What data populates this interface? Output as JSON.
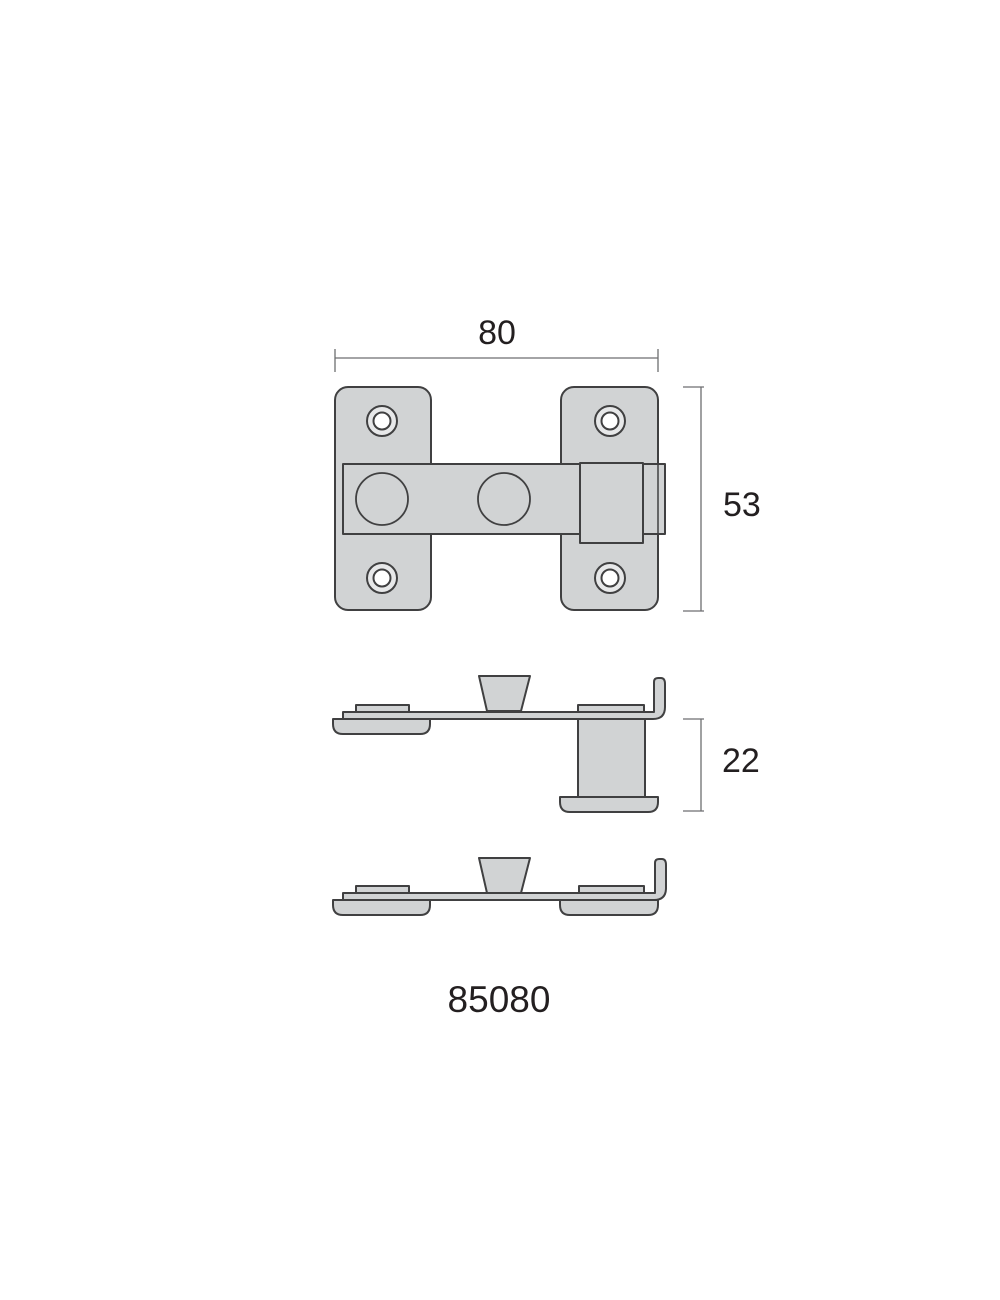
{
  "product_code": "85080",
  "dimension_labels": {
    "overall_width": "80",
    "overall_height": "53",
    "keeper_projection": "22"
  },
  "colors": {
    "background": "#ffffff",
    "part_fill": "#d1d3d4",
    "part_outline": "#404041",
    "hole_ring_fill": "#e7e8e9",
    "hole_center_fill": "#ffffff",
    "dimension_line": "#6d6e70",
    "label_text": "#231f20"
  }
}
